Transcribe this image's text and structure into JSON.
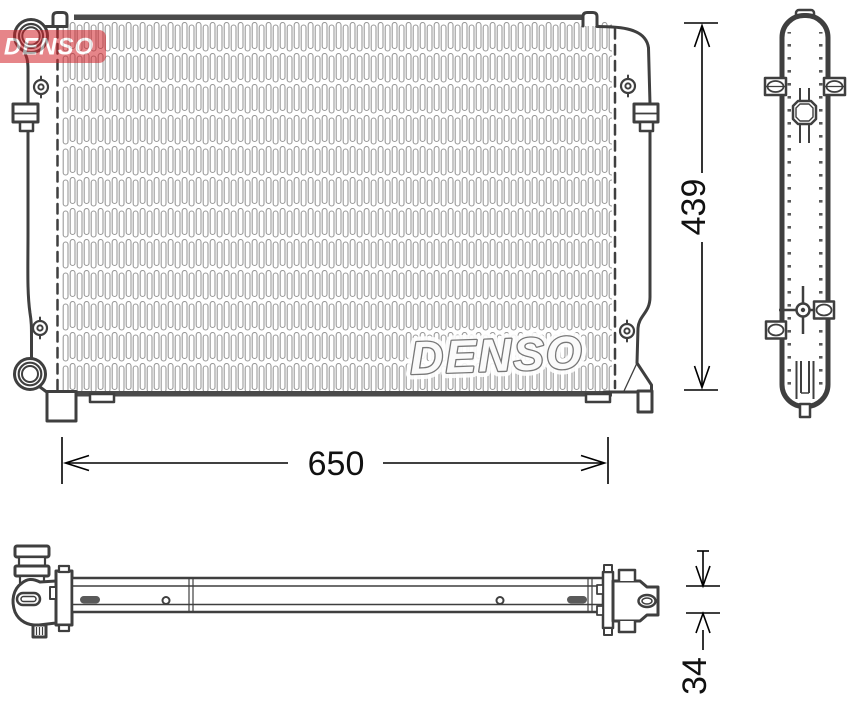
{
  "drawing": {
    "brand_logo": {
      "text": "DENSO",
      "color": "#d2232a"
    },
    "core_watermark": {
      "text": "DENSO"
    },
    "dimensions": {
      "width": {
        "value": "650"
      },
      "height": {
        "value": "439"
      },
      "thickness": {
        "value": "34"
      }
    },
    "colors": {
      "background": "#ffffff",
      "outline": "#3f3f3f",
      "fins": "#9a9a9a",
      "core_header": "#4a4a4a",
      "dimension_lines": "#000000"
    }
  }
}
